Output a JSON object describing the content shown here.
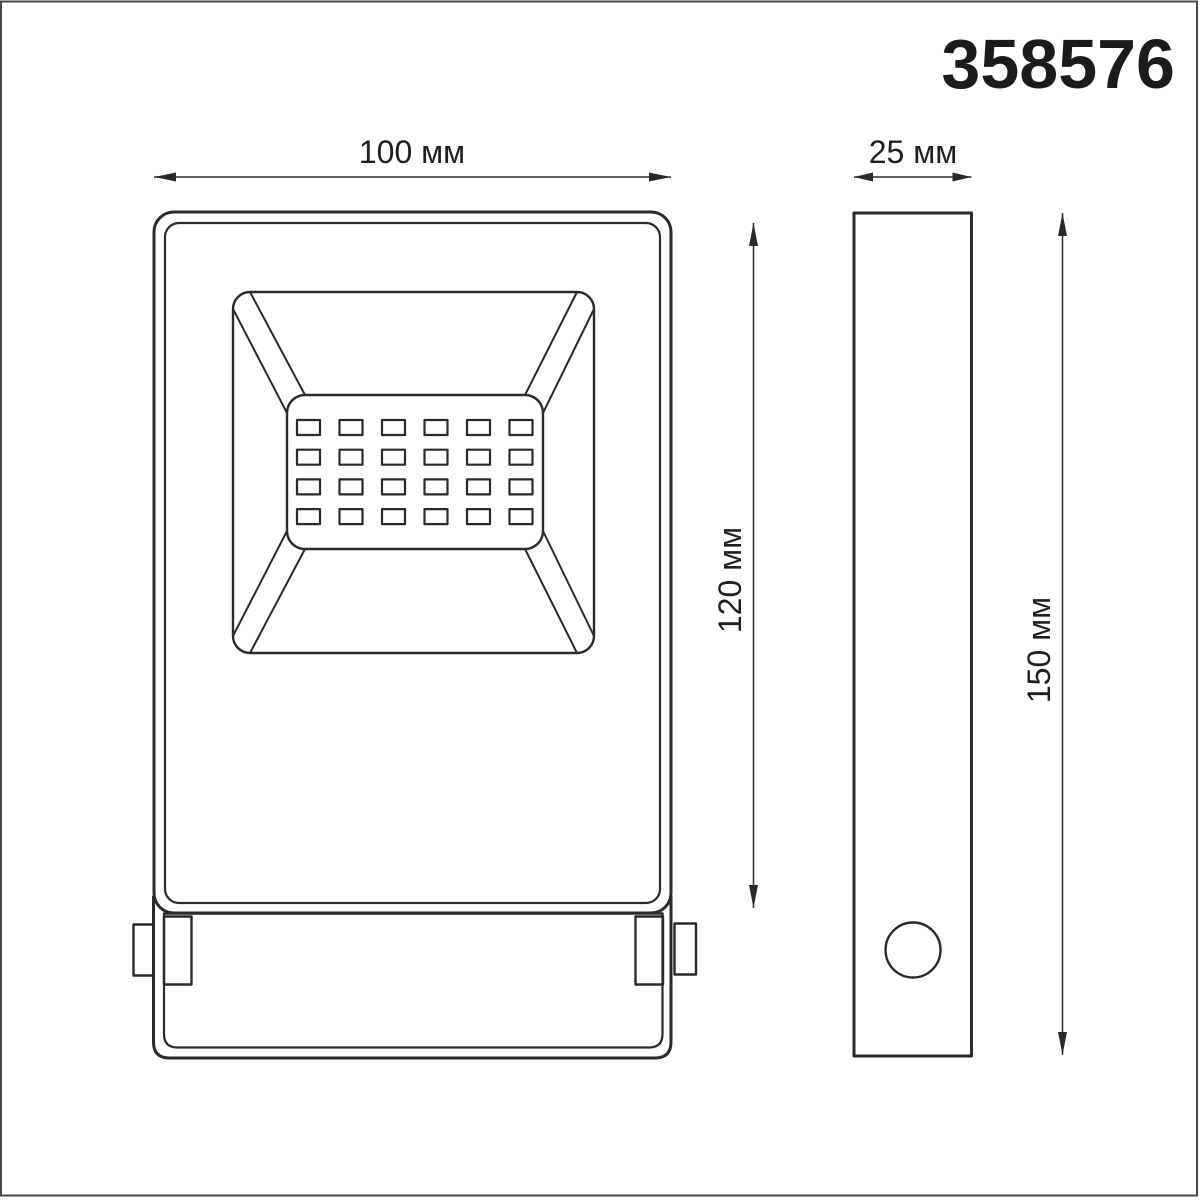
{
  "product": {
    "code": "358576"
  },
  "dimensions": {
    "width": {
      "label": "100 мм",
      "value": 100,
      "unit": "мм"
    },
    "depth": {
      "label": "25 мм",
      "value": 25,
      "unit": "мм"
    },
    "body_height": {
      "label": "120 мм",
      "value": 120,
      "unit": "мм"
    },
    "total_height": {
      "label": "150 мм",
      "value": 150,
      "unit": "мм"
    }
  },
  "views": {
    "front": {
      "name": "front view — floodlight with LED panel and mounting bracket"
    },
    "side": {
      "name": "side view — slim profile with cable gland"
    }
  },
  "led_grid": {
    "columns": 6,
    "rows": 4
  },
  "colors": {
    "background": "#ffffff",
    "line": "#2a2a2a",
    "text": "#1f1f1f",
    "border": "#4a4a4a"
  }
}
